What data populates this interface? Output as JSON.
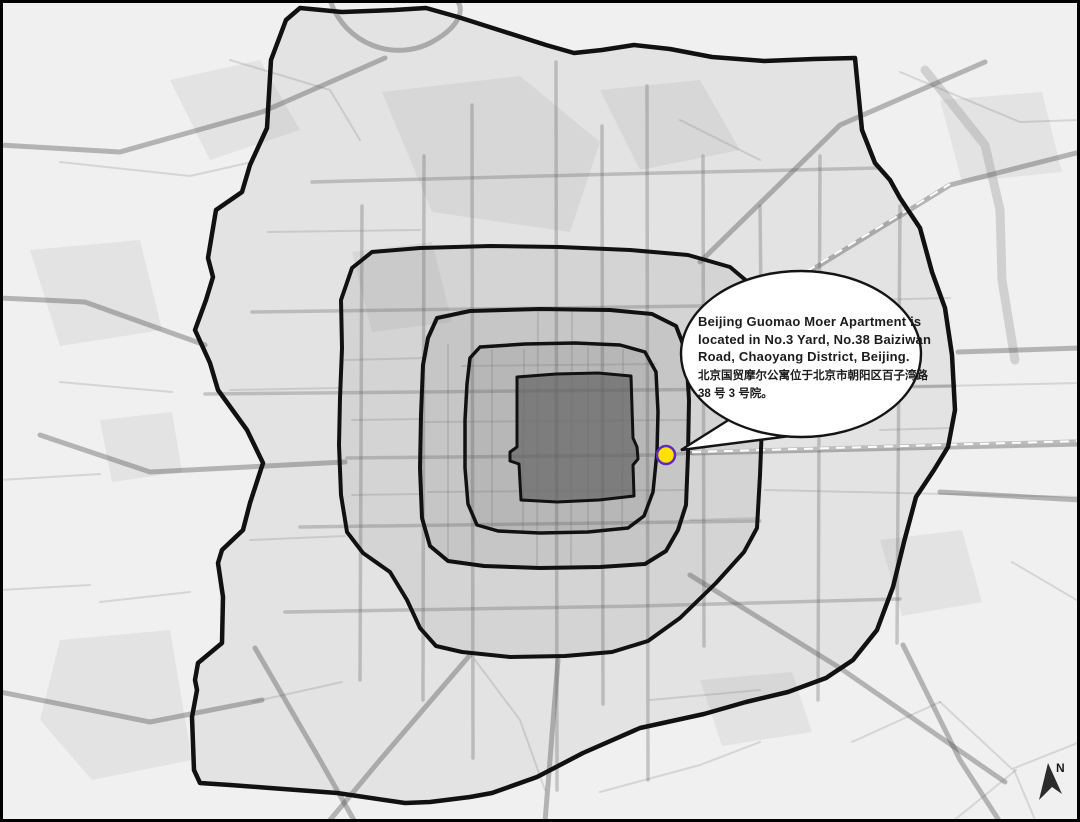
{
  "callout": {
    "lines": [
      "Beijing Guomao Moer Apartment is",
      "located in No.3 Yard, No.38 Baiziwan",
      "Road, Chaoyang District, Beijing.",
      "北京国贸摩尔公寓位于北京市朝阳区百子湾路",
      "38 号 3 号院。"
    ]
  },
  "compass": {
    "label": "N"
  },
  "marker": {
    "fill": "#FFE000",
    "stroke": "#5B2CBF"
  },
  "colors": {
    "background": "#f0f0f0",
    "ring_outline": "#111111",
    "ring6_fill": "#e3e3e3",
    "ring5_fill": "#d4d4d4",
    "ring4_fill": "#c6c6c6",
    "ring3_fill": "#b7b7b7",
    "ring2_fill": "#7d7d7d",
    "bubble_fill": "#ffffff",
    "bubble_stroke": "#141414",
    "north_arrow": "#2b2b2b",
    "border": "#000000"
  }
}
